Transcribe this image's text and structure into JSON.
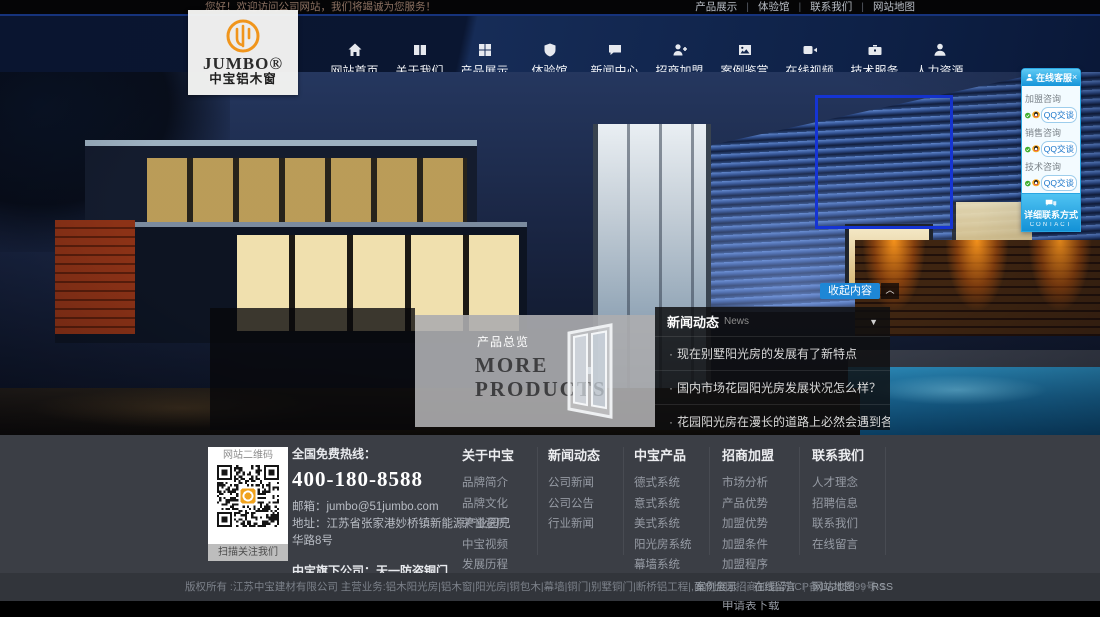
{
  "topbar": {
    "welcome": "您好！欢迎访问公司网站，我们将竭诚为您服务！",
    "links": [
      "产品展示",
      "体验馆",
      "联系我们",
      "网站地图"
    ]
  },
  "logo": {
    "brand": "JUMBO®",
    "subtitle": "中宝铝木窗"
  },
  "nav": {
    "items": [
      {
        "label": "网站首页",
        "icon": "home-icon"
      },
      {
        "label": "关于我们",
        "icon": "book-icon"
      },
      {
        "label": "产品展示",
        "icon": "grid-icon"
      },
      {
        "label": "体验馆",
        "icon": "shield-icon"
      },
      {
        "label": "新闻中心",
        "icon": "chat-icon"
      },
      {
        "label": "招商加盟",
        "icon": "person-plus-icon"
      },
      {
        "label": "案例鉴赏",
        "icon": "photo-icon"
      },
      {
        "label": "在线视频",
        "icon": "video-icon"
      },
      {
        "label": "技术服务",
        "icon": "briefcase-icon"
      },
      {
        "label": "人力资源",
        "icon": "person-icon"
      }
    ]
  },
  "hero": {
    "collapse_button": "收起内容",
    "collapse_aux_icon": "chevron-up",
    "products": {
      "tag": "产品总览",
      "title_line1": "MORE",
      "title_line2": "PRODUCTS"
    },
    "news": {
      "title": "新闻动态",
      "subtitle": "News",
      "items": [
        "现在别墅阳光房的发展有了新特点",
        "国内市场花园阳光房发展状况怎么样？",
        "花园阳光房在漫长的道路上必然会遇到各种挑战"
      ]
    }
  },
  "qq_panel": {
    "title": "在线客服",
    "close": "×",
    "groups": [
      {
        "label": "加盟咨询",
        "button": "QQ交谈"
      },
      {
        "label": "销售咨询",
        "button": "QQ交谈"
      },
      {
        "label": "技术咨询",
        "button": "QQ交谈"
      }
    ],
    "footer": "详细联系方式",
    "footer_sub": "CONTACT"
  },
  "footer": {
    "qr": {
      "title": "网站二维码",
      "caption": "扫描关注我们"
    },
    "hotline_label": "全国免费热线：",
    "hotline": "400-180-8588",
    "email": "邮箱：jumbo@51jumbo.com",
    "address": "地址：江苏省张家港妙桥镇新能源产业园兄华路8号",
    "subsidiary": "中宝旗下公司：天一防盗铜门",
    "columns": [
      {
        "title": "关于中宝",
        "links": [
          "品牌简介",
          "品牌文化",
          "荣誉资质",
          "中宝视频",
          "发展历程",
          "品牌形象"
        ]
      },
      {
        "title": "新闻动态",
        "links": [
          "公司新闻",
          "公司公告",
          "行业新闻"
        ]
      },
      {
        "title": "中宝产品",
        "links": [
          "德式系统",
          "意式系统",
          "美式系统",
          "阳光房系统",
          "幕墙系统",
          "断桥铝系统"
        ]
      },
      {
        "title": "招商加盟",
        "links": [
          "市场分析",
          "产品优势",
          "加盟优势",
          "加盟条件",
          "加盟程序",
          "加盟留言",
          "申请表下载"
        ]
      },
      {
        "title": "联系我们",
        "links": [
          "人才理念",
          "招聘信息",
          "联系我们",
          "在线留言"
        ]
      }
    ]
  },
  "bottombar": {
    "copyright": "版权所有 :江苏中宝建材有限公司 主营业务:铝木阳光房|铝木窗|阳光房|铜包木|幕墙|铜门|别墅铜门|断桥铝工程|,面向全国招商加盟 苏ICP备10215699号-1",
    "links": [
      "案例展示",
      "在线留言",
      "网站地图",
      "RSS"
    ]
  },
  "colors": {
    "accent_orange": "#f0a21c",
    "nav_bg": "#0c1c3e",
    "qq_blue": "#2bb0ea",
    "button_blue": "#1e87d6",
    "footer_bg": "#3b3e45",
    "link_blue": "#1673c9"
  }
}
